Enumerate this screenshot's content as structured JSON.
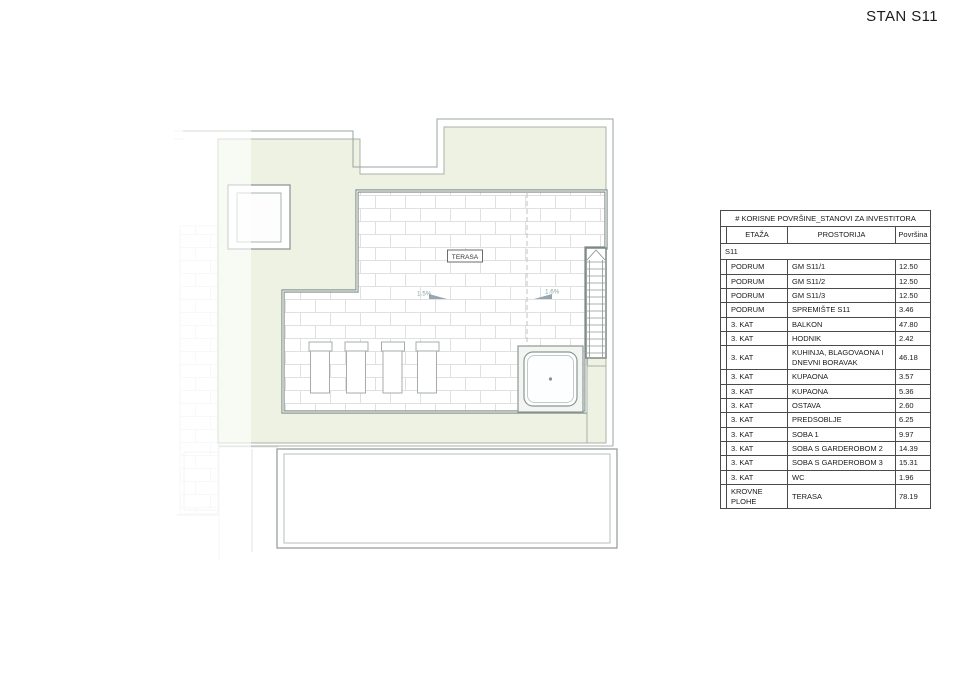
{
  "title": "STAN S11",
  "plan": {
    "terrace_label": "TERASA",
    "slope_left": "1.5%",
    "slope_right": "1.6%",
    "colors": {
      "roof_green": "#edf2e3",
      "green_edge": "#a9b3a7",
      "terrace_border": "#7d8a84",
      "brick_line": "#e0e0e0",
      "outline_grey": "#9aa49e",
      "slope_text": "#85a79d"
    }
  },
  "table": {
    "title": "# KORISNE POVRŠINE_STANOVI ZA INVESTITORA",
    "columns": [
      "ETAŽA",
      "PROSTORIJA",
      "Površina"
    ],
    "group": "S11",
    "rows": [
      {
        "etaza": "PODRUM",
        "prostorija": "GM S11/1",
        "povrsina": "12.50"
      },
      {
        "etaza": "PODRUM",
        "prostorija": "GM S11/2",
        "povrsina": "12.50"
      },
      {
        "etaza": "PODRUM",
        "prostorija": "GM S11/3",
        "povrsina": "12.50"
      },
      {
        "etaza": "PODRUM",
        "prostorija": "SPREMIŠTE S11",
        "povrsina": "3.46"
      },
      {
        "etaza": "3. KAT",
        "prostorija": "BALKON",
        "povrsina": "47.80"
      },
      {
        "etaza": "3. KAT",
        "prostorija": "HODNIK",
        "povrsina": "2.42"
      },
      {
        "etaza": "3. KAT",
        "prostorija": "KUHINJA, BLAGOVAONA I DNEVNI BORAVAK",
        "povrsina": "46.18"
      },
      {
        "etaza": "3. KAT",
        "prostorija": "KUPAONA",
        "povrsina": "3.57"
      },
      {
        "etaza": "3. KAT",
        "prostorija": "KUPAONA",
        "povrsina": "5.36"
      },
      {
        "etaza": "3. KAT",
        "prostorija": "OSTAVA",
        "povrsina": "2.60"
      },
      {
        "etaza": "3. KAT",
        "prostorija": "PREDSOBLJE",
        "povrsina": "6.25"
      },
      {
        "etaza": "3. KAT",
        "prostorija": "SOBA 1",
        "povrsina": "9.97"
      },
      {
        "etaza": "3. KAT",
        "prostorija": "SOBA S GARDEROBOM 2",
        "povrsina": "14.39"
      },
      {
        "etaza": "3. KAT",
        "prostorija": "SOBA S GARDEROBOM 3",
        "povrsina": "15.31"
      },
      {
        "etaza": "3. KAT",
        "prostorija": "WC",
        "povrsina": "1.96"
      },
      {
        "etaza": "KROVNE PLOHE",
        "prostorija": "TERASA",
        "povrsina": "78.19"
      }
    ]
  }
}
